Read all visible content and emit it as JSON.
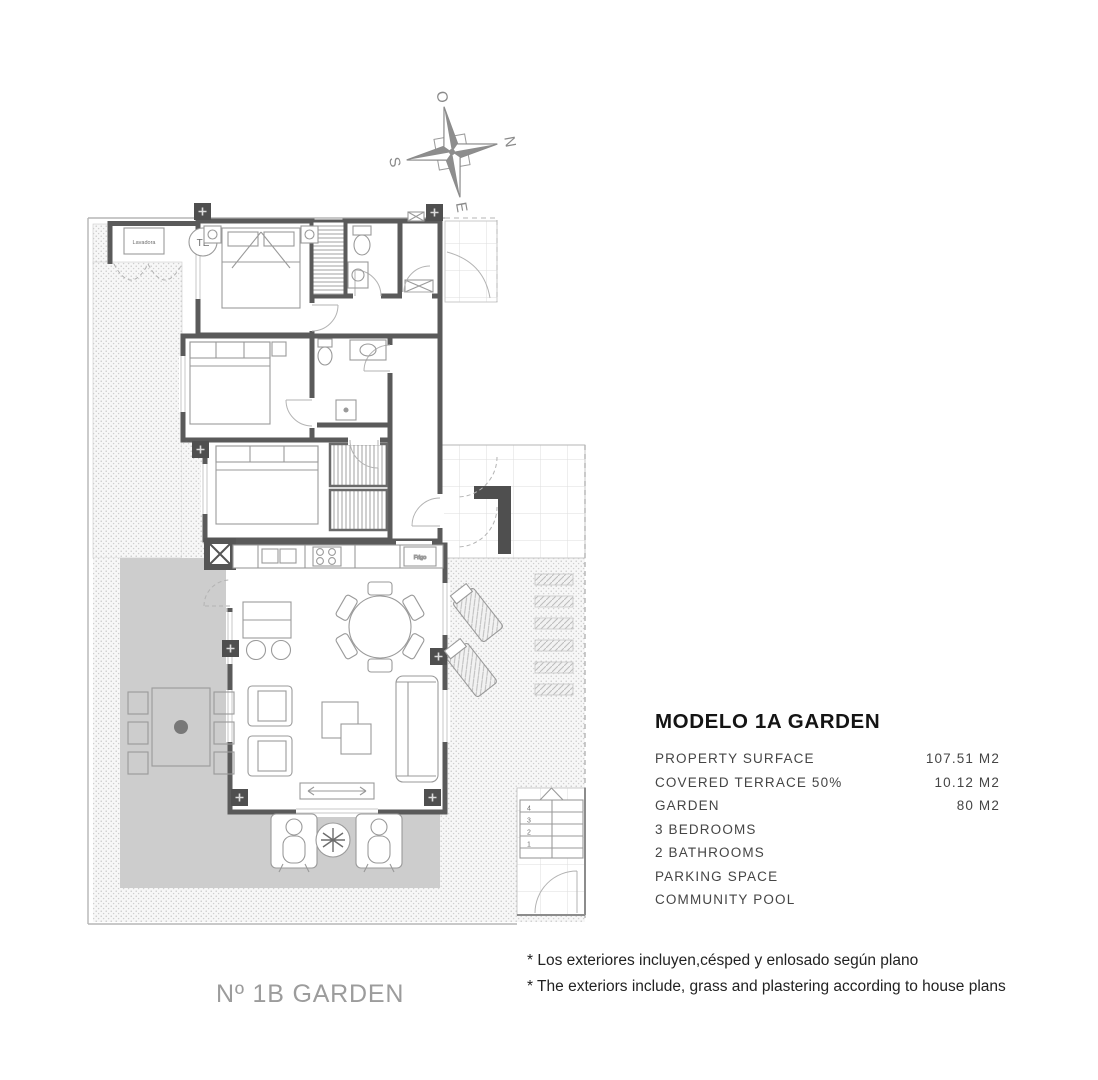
{
  "compass": {
    "west": "O",
    "north": "N",
    "south": "S",
    "east": "E"
  },
  "plan": {
    "unit_label": "Nº 1B GARDEN",
    "labels": {
      "washer": "Lavadora",
      "water_heater": "TE",
      "fridge": "Frigo"
    },
    "stair_steps": [
      "4",
      "3",
      "2",
      "1"
    ],
    "colors": {
      "wall": "#5a5a5a",
      "terrace": "#cdcdcd",
      "plot_line": "#b5b5b5",
      "furniture_line": "#9a9a9a"
    }
  },
  "specs": {
    "title": "MODELO 1A GARDEN",
    "rows": [
      {
        "label": "PROPERTY SURFACE",
        "value": "107.51 M2"
      },
      {
        "label": "COVERED TERRACE 50%",
        "value": "10.12 M2"
      },
      {
        "label": "GARDEN",
        "value": "80 M2"
      },
      {
        "label": "3 BEDROOMS",
        "value": ""
      },
      {
        "label": "2 BATHROOMS",
        "value": ""
      },
      {
        "label": "PARKING SPACE",
        "value": ""
      },
      {
        "label": "COMMUNITY POOL",
        "value": ""
      }
    ]
  },
  "footnotes": [
    "* Los exteriores incluyen,césped y enlosado según plano",
    "* The exteriors include, grass and plastering according to house plans"
  ]
}
